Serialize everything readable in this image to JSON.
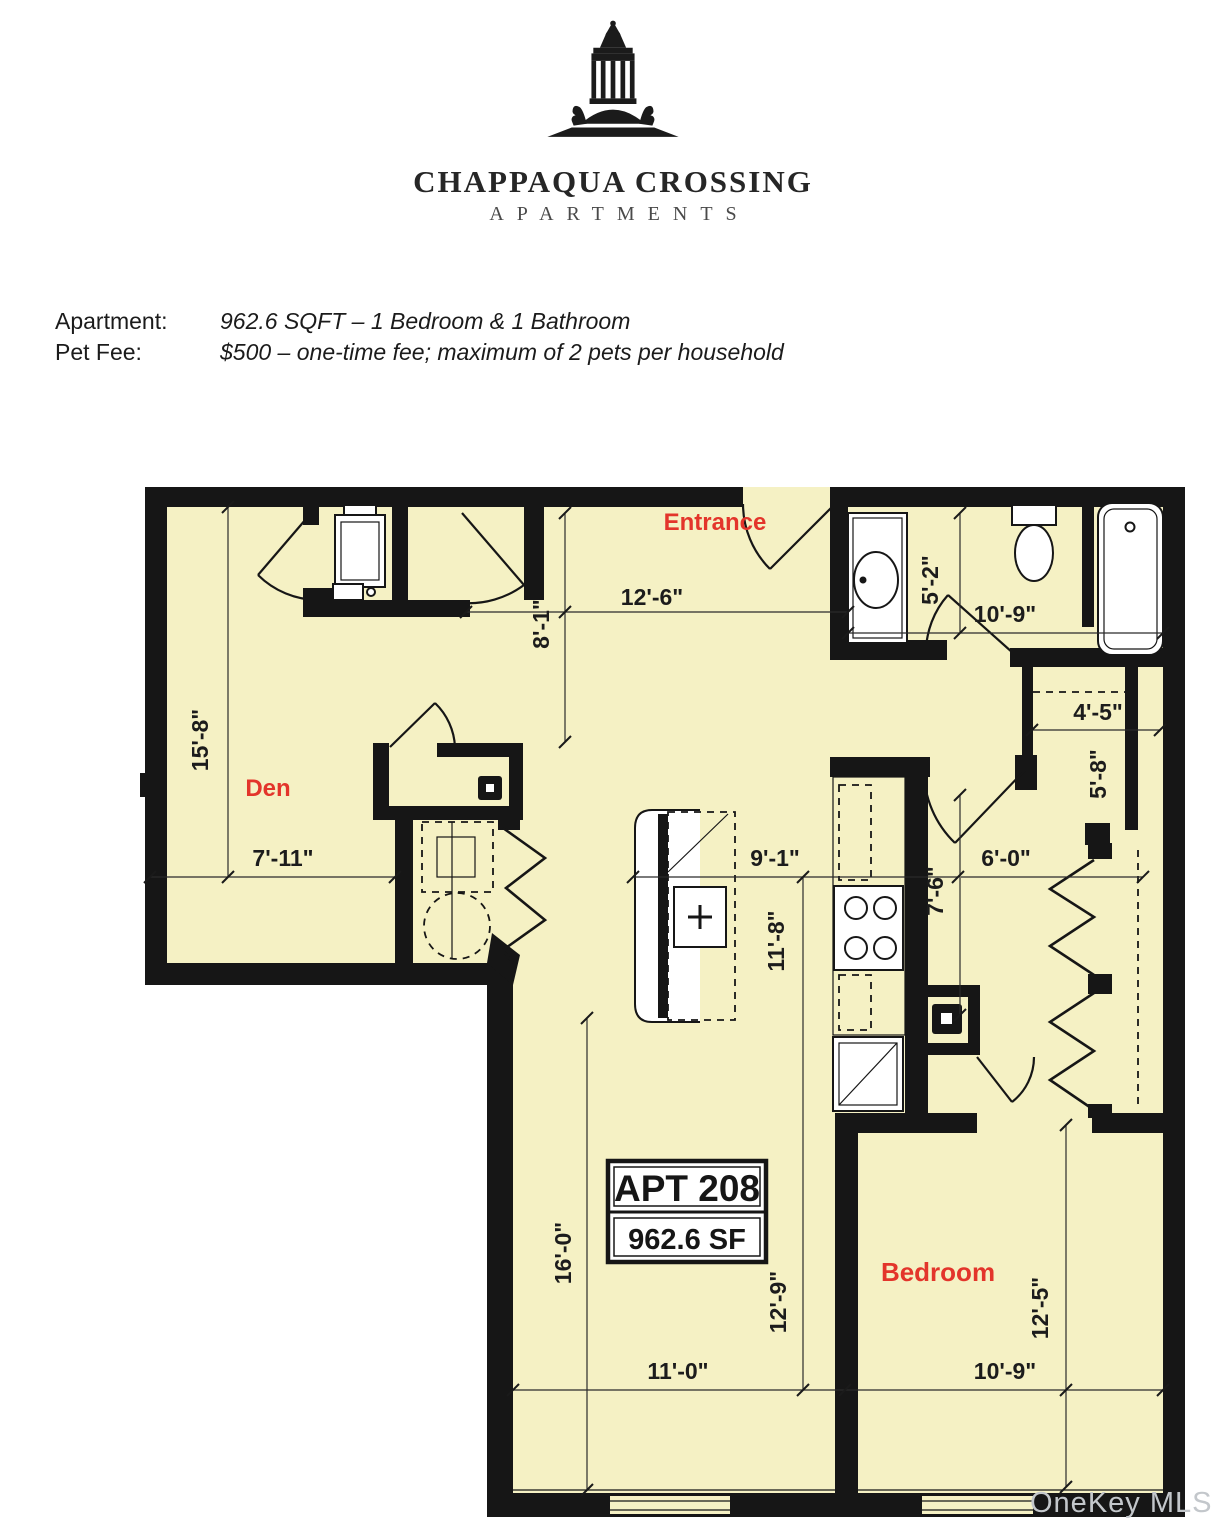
{
  "page": {
    "background": "#ffffff"
  },
  "logo": {
    "name": "CHAPPAQUA CROSSING",
    "tagline": "APARTMENTS"
  },
  "details": {
    "rows": [
      {
        "label": "Apartment:",
        "value": "962.6 SQFT – 1 Bedroom & 1 Bathroom"
      },
      {
        "label": "Pet Fee:",
        "value": "$500 – one-time fee; maximum of 2 pets per household"
      }
    ]
  },
  "floorplan": {
    "unit_label": "APT 208",
    "unit_area": "962.6 SF",
    "rooms": [
      {
        "name": "Entrance"
      },
      {
        "name": "Den"
      },
      {
        "name": "Bedroom"
      }
    ],
    "dimensions": {
      "entry_width": "12'-6\"",
      "entry_depth": "8'-1\"",
      "bath_width": "10'-9\"",
      "bath_depth": "5'-2\"",
      "linen_closet_width": "4'-5\"",
      "closet_depth": "5'-8\"",
      "den_depth": "15'-8\"",
      "den_width": "7'-11\"",
      "kitchen_width": "9'-1\"",
      "kitchen_depth": "11'-8\"",
      "hall_width": "6'-0\"",
      "hall_depth": "7'-6\"",
      "living_depth": "16'-0\"",
      "living_inner_depth": "12'-9\"",
      "living_width": "11'-0\"",
      "bedroom_width": "10'-9\"",
      "bedroom_depth": "12'-5\""
    },
    "colors": {
      "floor": "#f5f1c4",
      "wall": "#161616",
      "room_label": "#e3352b",
      "dimension_text": "#1c1c1c"
    },
    "watermark": "OneKey MLS"
  }
}
